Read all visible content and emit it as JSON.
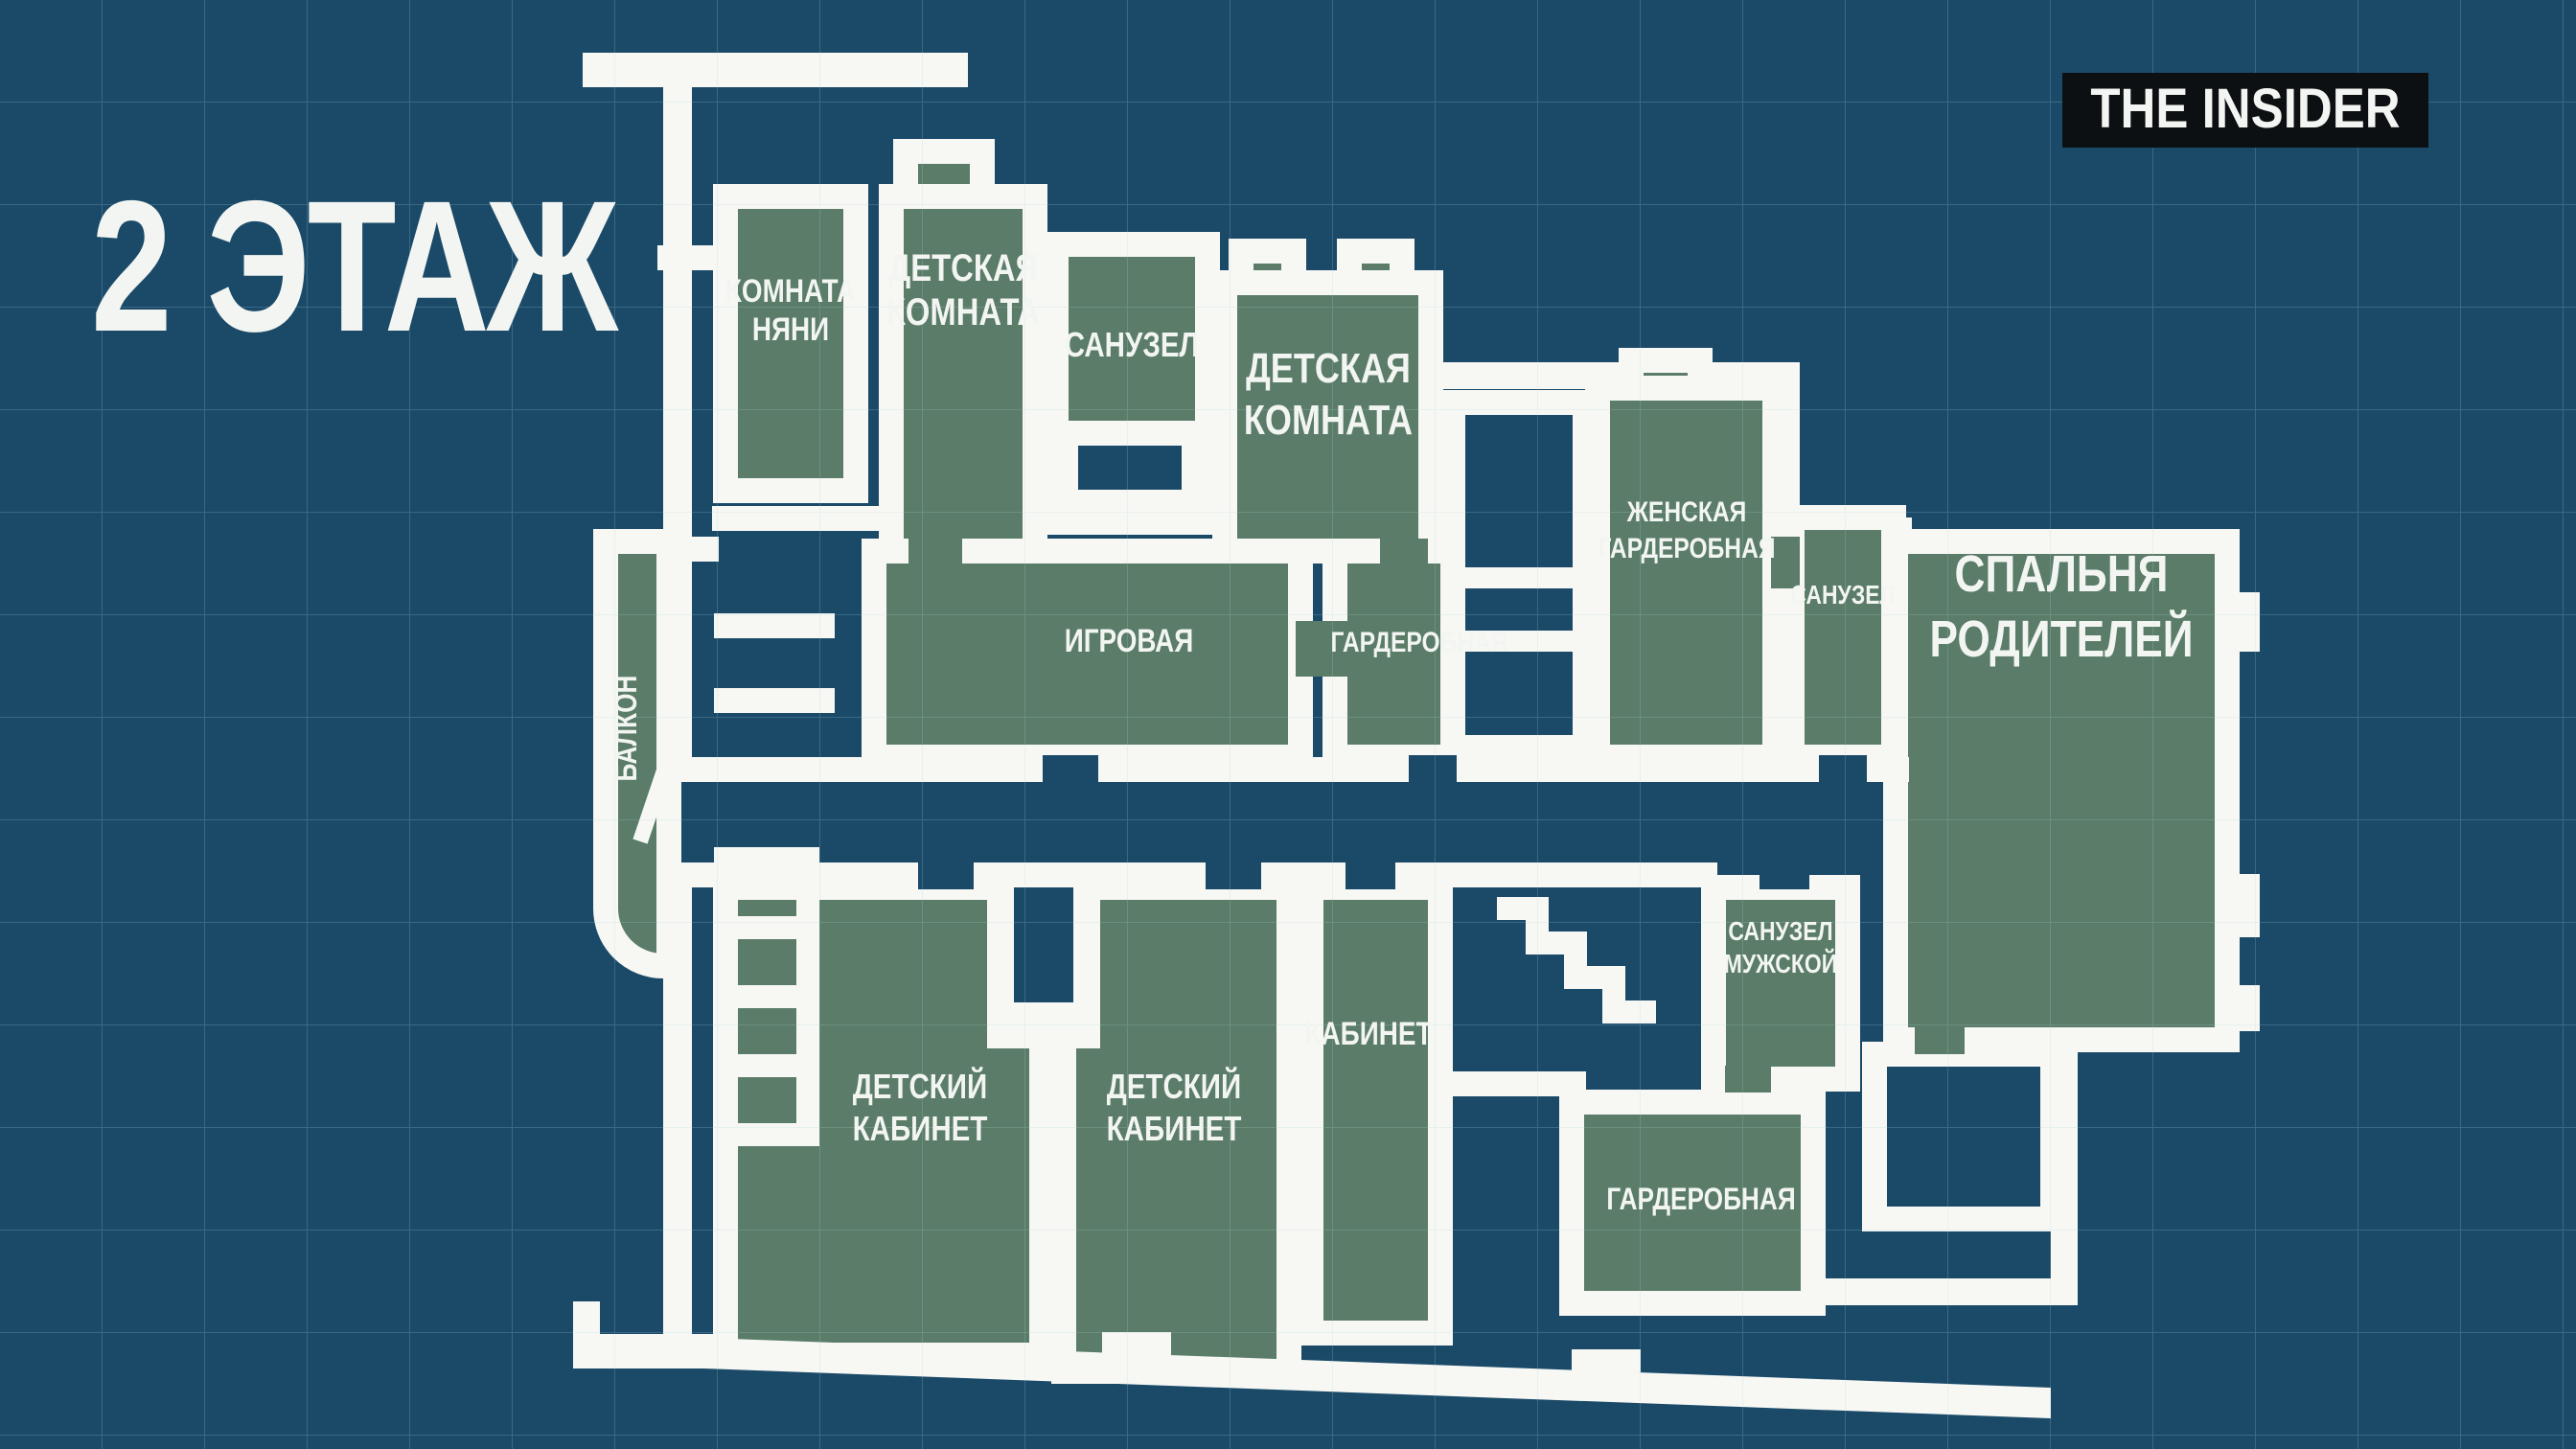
{
  "title": "2 ЭТАЖ",
  "logo": {
    "text": "THE INSIDER"
  },
  "colors": {
    "background": "#1b4a69",
    "grid": "#a8cfe0",
    "room_fill": "#5a7c68",
    "wall": "#f7f8f4",
    "logo_background": "#0c1013",
    "text": "#f2f5f1"
  },
  "rooms": {
    "nanny": {
      "line1": "КОМНАТА",
      "line2": "НЯНИ"
    },
    "kids_room_left": {
      "line1": "ДЕТСКАЯ",
      "line2": "КОМНАТА"
    },
    "bath_top": {
      "line1": "САНУЗЕЛ"
    },
    "kids_room_center": {
      "line1": "ДЕТСКАЯ",
      "line2": "КОМНАТА"
    },
    "playroom": {
      "line1": "ИГРОВАЯ"
    },
    "wardrobe_center": {
      "line1": "ГАРДЕРОБНАЯ"
    },
    "women_wardrobe": {
      "line1": "ЖЕНСКАЯ",
      "line2": "ГАРДЕРОБНАЯ"
    },
    "bath_right": {
      "line1": "САНУЗЕЛ"
    },
    "master_bedroom": {
      "line1": "СПАЛЬНЯ",
      "line2": "РОДИТЕЛЕЙ"
    },
    "balcony": {
      "line1": "БАЛКОН"
    },
    "kids_office_left": {
      "line1": "ДЕТСКИЙ",
      "line2": "КАБИНЕТ"
    },
    "kids_office_right": {
      "line1": "ДЕТСКИЙ",
      "line2": "КАБИНЕТ"
    },
    "office": {
      "line1": "КАБИНЕТ"
    },
    "bath_male": {
      "line1": "САНУЗЕЛ",
      "line2": "МУЖСКОЙ"
    },
    "wardrobe_bottom": {
      "line1": "ГАРДЕРОБНАЯ"
    }
  }
}
